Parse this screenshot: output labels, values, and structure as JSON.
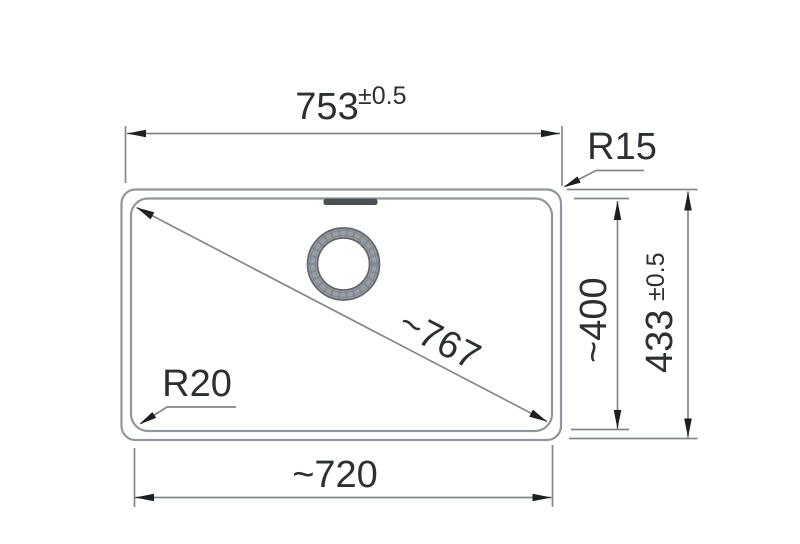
{
  "drawing": {
    "type": "technical-dimension-drawing",
    "dimensions": {
      "outer_width": {
        "value": "753",
        "tolerance": "±0.5"
      },
      "outer_depth": {
        "value": "433",
        "tolerance": "±0.5"
      },
      "inner_width": {
        "value": "~720"
      },
      "inner_depth": {
        "value": "~400"
      },
      "diagonal": {
        "value": "~767"
      }
    },
    "radii": {
      "outer_corner": {
        "label": "R15"
      },
      "inner_corner": {
        "label": "R20"
      }
    },
    "colors": {
      "background": "#ffffff",
      "outline": "#90969b",
      "dimension_line": "#83888c",
      "arrowhead": "#1d2023",
      "text": "#2d3033",
      "drain_ring": "#989ea4",
      "drain_ring_edge": "#62686e",
      "overflow_slot": "#4b5054"
    }
  }
}
